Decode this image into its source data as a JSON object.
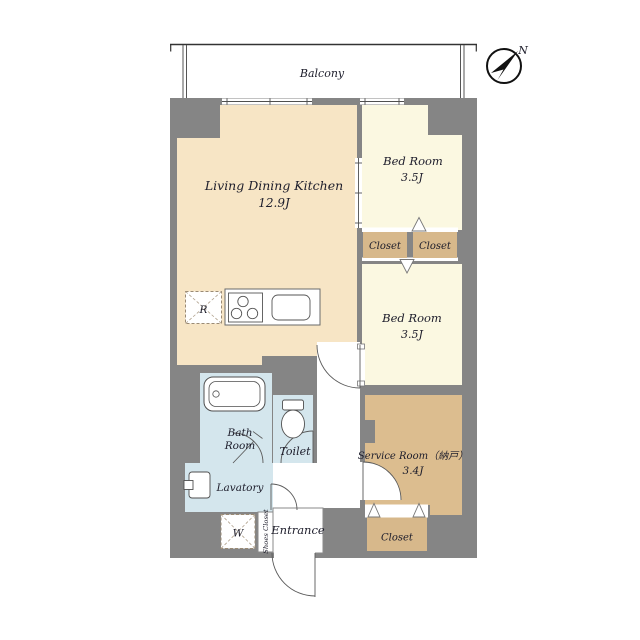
{
  "balcony": {
    "label": "Balcony"
  },
  "compass": {
    "north_label": "N"
  },
  "rooms": {
    "ldk": {
      "name": "Living Dining Kitchen",
      "size": "12.9J"
    },
    "bedroom_top": {
      "name": "Bed Room",
      "size": "3.5J"
    },
    "bedroom_mid": {
      "name": "Bed Room",
      "size": "3.5J"
    },
    "service_room": {
      "name": "Service Room（納戸）",
      "size": "3.4J"
    },
    "bath": {
      "name_line1": "Bath",
      "name_line2": "Room"
    },
    "toilet": {
      "name": "Toilet"
    },
    "lavatory": {
      "name": "Lavatory"
    },
    "entrance": {
      "name": "Entrance"
    },
    "shoes_closet": {
      "name": "Shoes Closet"
    },
    "closet_top_left": {
      "name": "Closet"
    },
    "closet_top_right": {
      "name": "Closet"
    },
    "closet_bottom": {
      "name": "Closet"
    }
  },
  "fixtures": {
    "refrigerator_mark": "R",
    "washer_mark": "W"
  },
  "colors": {
    "wall": "#858585",
    "ldk": "#f7e5c5",
    "bedroom": "#fbf8e1",
    "closet": "#d7b88b",
    "service": "#dcbd8f",
    "wet": "#d4e6ed",
    "ink": "#1d1d2b",
    "line": "#4f4f4f"
  }
}
